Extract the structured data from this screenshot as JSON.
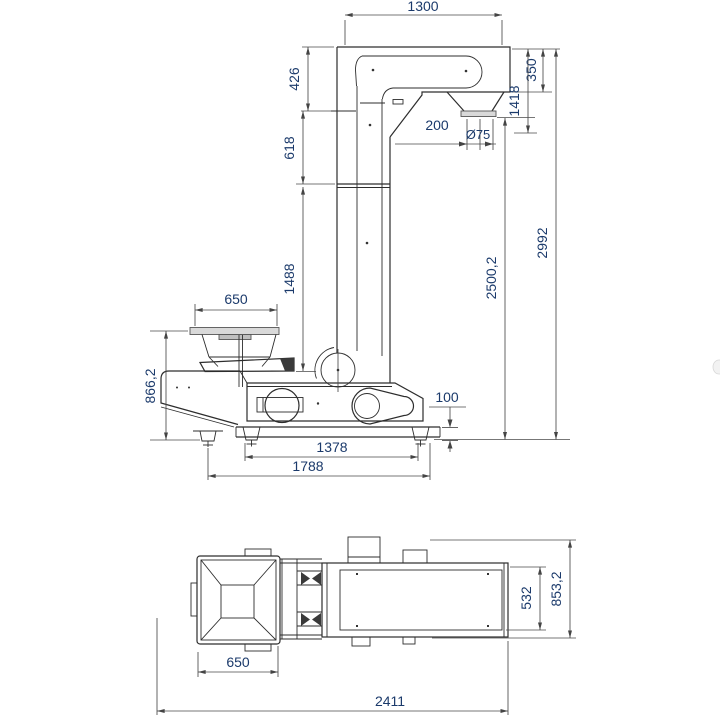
{
  "drawing": {
    "title": "Z-type bucket elevator dimensional drawing",
    "side_view": {
      "label": "side-elevation-view",
      "dims": {
        "head_width": "1300",
        "head_left_drop": "426",
        "upper_column": "618",
        "mid_column": "1488",
        "hopper_width": "650",
        "hopper_height": "866,2",
        "head_height": "350",
        "head_to_outlet": "1418",
        "outlet_width": "200",
        "outlet_diameter": "Ø75",
        "outlet_height": "2500,2",
        "total_height": "2992",
        "foot_height": "100",
        "foot_spacing": "1378",
        "base_length": "1788"
      }
    },
    "plan_view": {
      "label": "top-plan-view",
      "dims": {
        "hopper_width": "650",
        "overall_length": "2411",
        "conveyor_width": "532",
        "overall_width": "853,2"
      }
    },
    "colors": {
      "object_line": "#2d2d2d",
      "dimension_line": "#4a4a4a",
      "dimension_text": "#1b3a6b",
      "fill_light": "#d9d9d9",
      "fill_dark": "#3a3a3a",
      "background": "#ffffff"
    }
  }
}
